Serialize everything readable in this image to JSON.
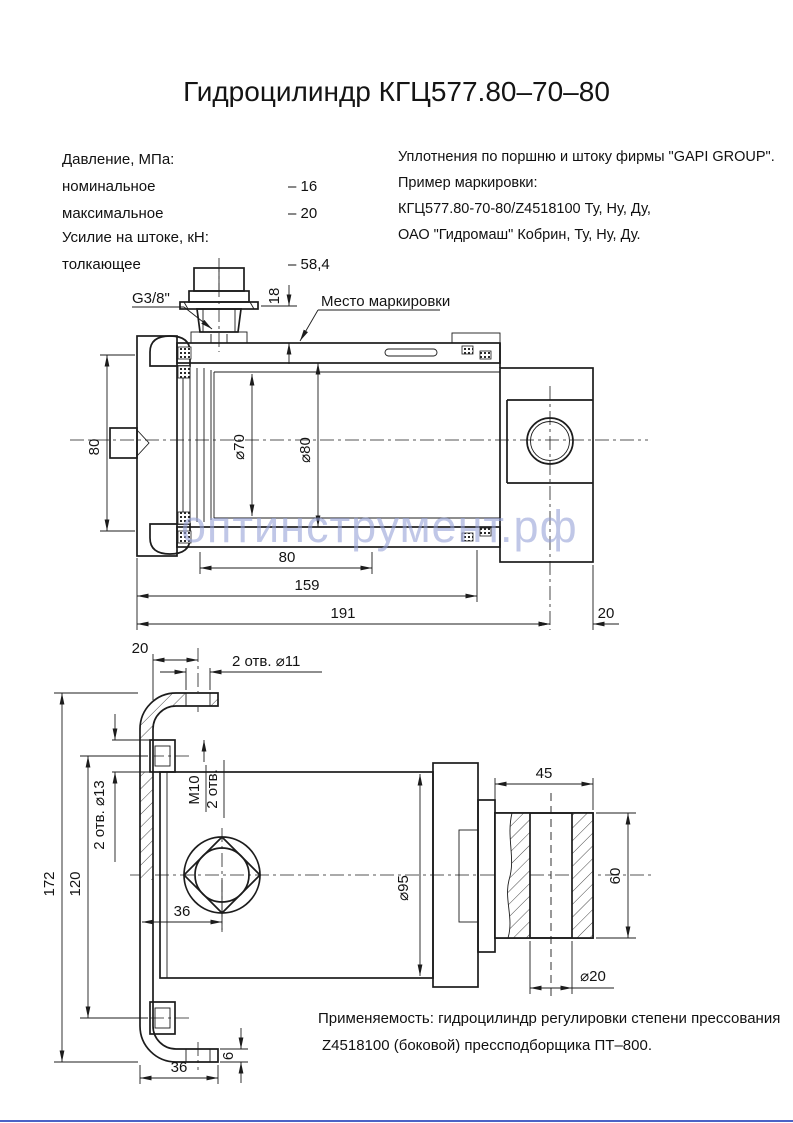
{
  "page": {
    "title": "Гидроцилиндр КГЦ577.80–70–80"
  },
  "specs": {
    "header1": "Давление, МПа:",
    "rows": [
      {
        "label": "номинальное",
        "value": "– 16"
      },
      {
        "label": "максимальное",
        "value": "– 20"
      }
    ],
    "header2": "Усилие на штоке, кН:",
    "rows2": [
      {
        "label": "толкающее",
        "value": "– 58,4"
      }
    ]
  },
  "notes": {
    "lines": [
      "Уплотнения по поршню и штоку фирмы \"GAPI GROUP\".",
      "Пример маркировки:",
      "КГЦ577.80-70-80/Z4518100 Ту, Ну, Ду,",
      "ОАО \"Гидромаш\" Кобрин, Ту, Ну, Ду."
    ]
  },
  "top_view": {
    "port_thread": "G3/8\"",
    "dim_18": "18",
    "marking_label": "Место маркировки",
    "dim_flange_height": "80",
    "dim_rod": "⌀70",
    "dim_bore": "⌀80",
    "dim_80": "80",
    "dim_159": "159",
    "dim_191": "191",
    "dim_20": "20"
  },
  "bottom_view": {
    "dim_20": "20",
    "holes_top": "2 отв. ⌀11",
    "dim_172": "172",
    "dim_120": "120",
    "holes_side": "2 отв. ⌀13",
    "thread": "M10",
    "thread_qty": "2 отв.",
    "dim_36": "36",
    "dim_body": "⌀95",
    "dim_45": "45",
    "dim_60": "60",
    "dim_bush": "⌀20",
    "dim_36_foot": "36",
    "dim_6": "6"
  },
  "application": {
    "line1": "Применяемость: гидроцилиндр регулировки степени прессования",
    "line2": "Z4518100 (боковой) прессподборщика ПТ–800."
  },
  "watermark": "оптинструмент.рф",
  "colors": {
    "line": "#1c1c1c",
    "watermark": "#97a2d8",
    "accent": "#4b63c6"
  }
}
